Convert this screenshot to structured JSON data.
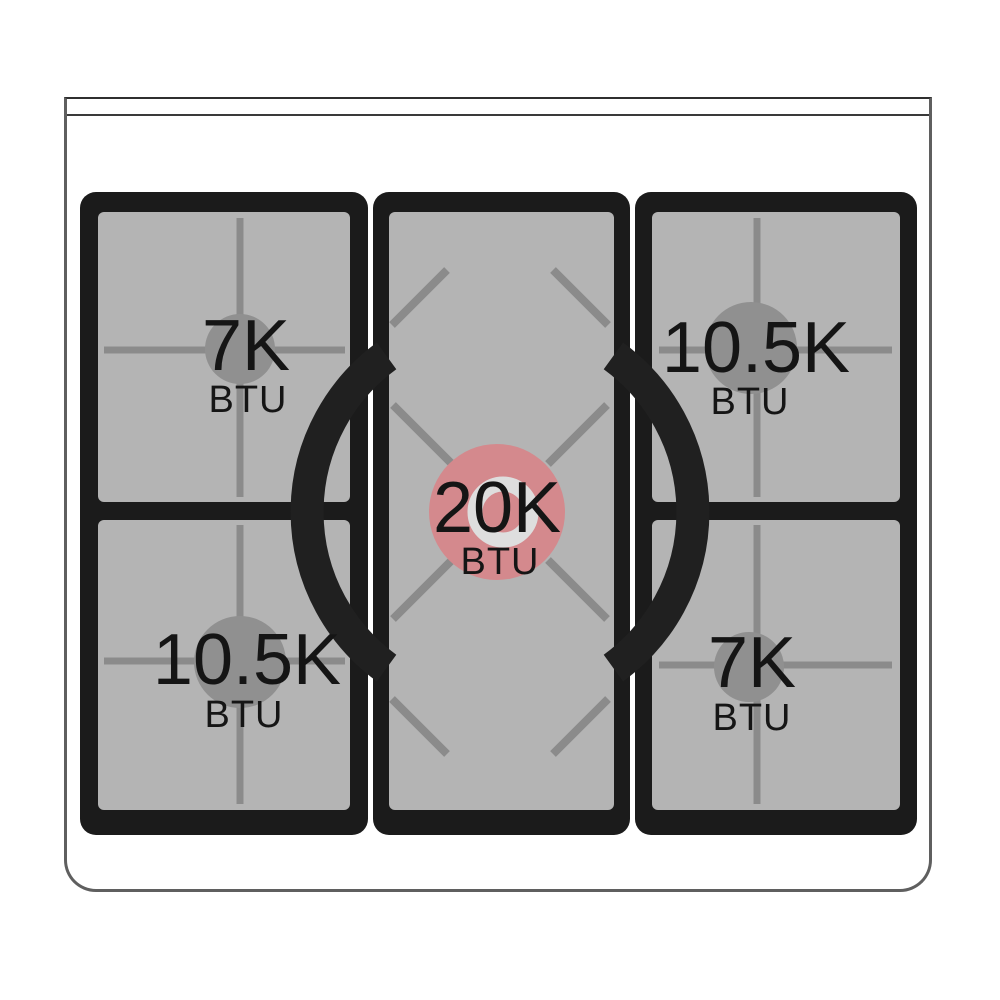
{
  "diagram_kind": "gas-cooktop-burner-power-diagram",
  "burners": {
    "top_left": {
      "value": "7K",
      "unit": "BTU",
      "size": "small",
      "highlighted": false
    },
    "top_right": {
      "value": "10.5K",
      "unit": "BTU",
      "size": "medium",
      "highlighted": false
    },
    "center": {
      "value": "20K",
      "unit": "BTU",
      "size": "large",
      "highlighted": true
    },
    "bottom_left": {
      "value": "10.5K",
      "unit": "BTU",
      "size": "medium",
      "highlighted": false
    },
    "bottom_right": {
      "value": "7K",
      "unit": "BTU",
      "size": "small",
      "highlighted": false
    }
  },
  "colors": {
    "highlight_burner_pink": "#d4898d",
    "burner_circle_gray": "#909090",
    "grate_black": "#1b1b1b",
    "plate_gray": "#b4b4b4",
    "grate_line_gray": "#8b8b8b",
    "wok_ring_black": "#202020",
    "donut_ring_light": "#dedede",
    "text_black": "#151515",
    "body_outline_gray": "#5f5f5f",
    "background_white": "#ffffff"
  }
}
